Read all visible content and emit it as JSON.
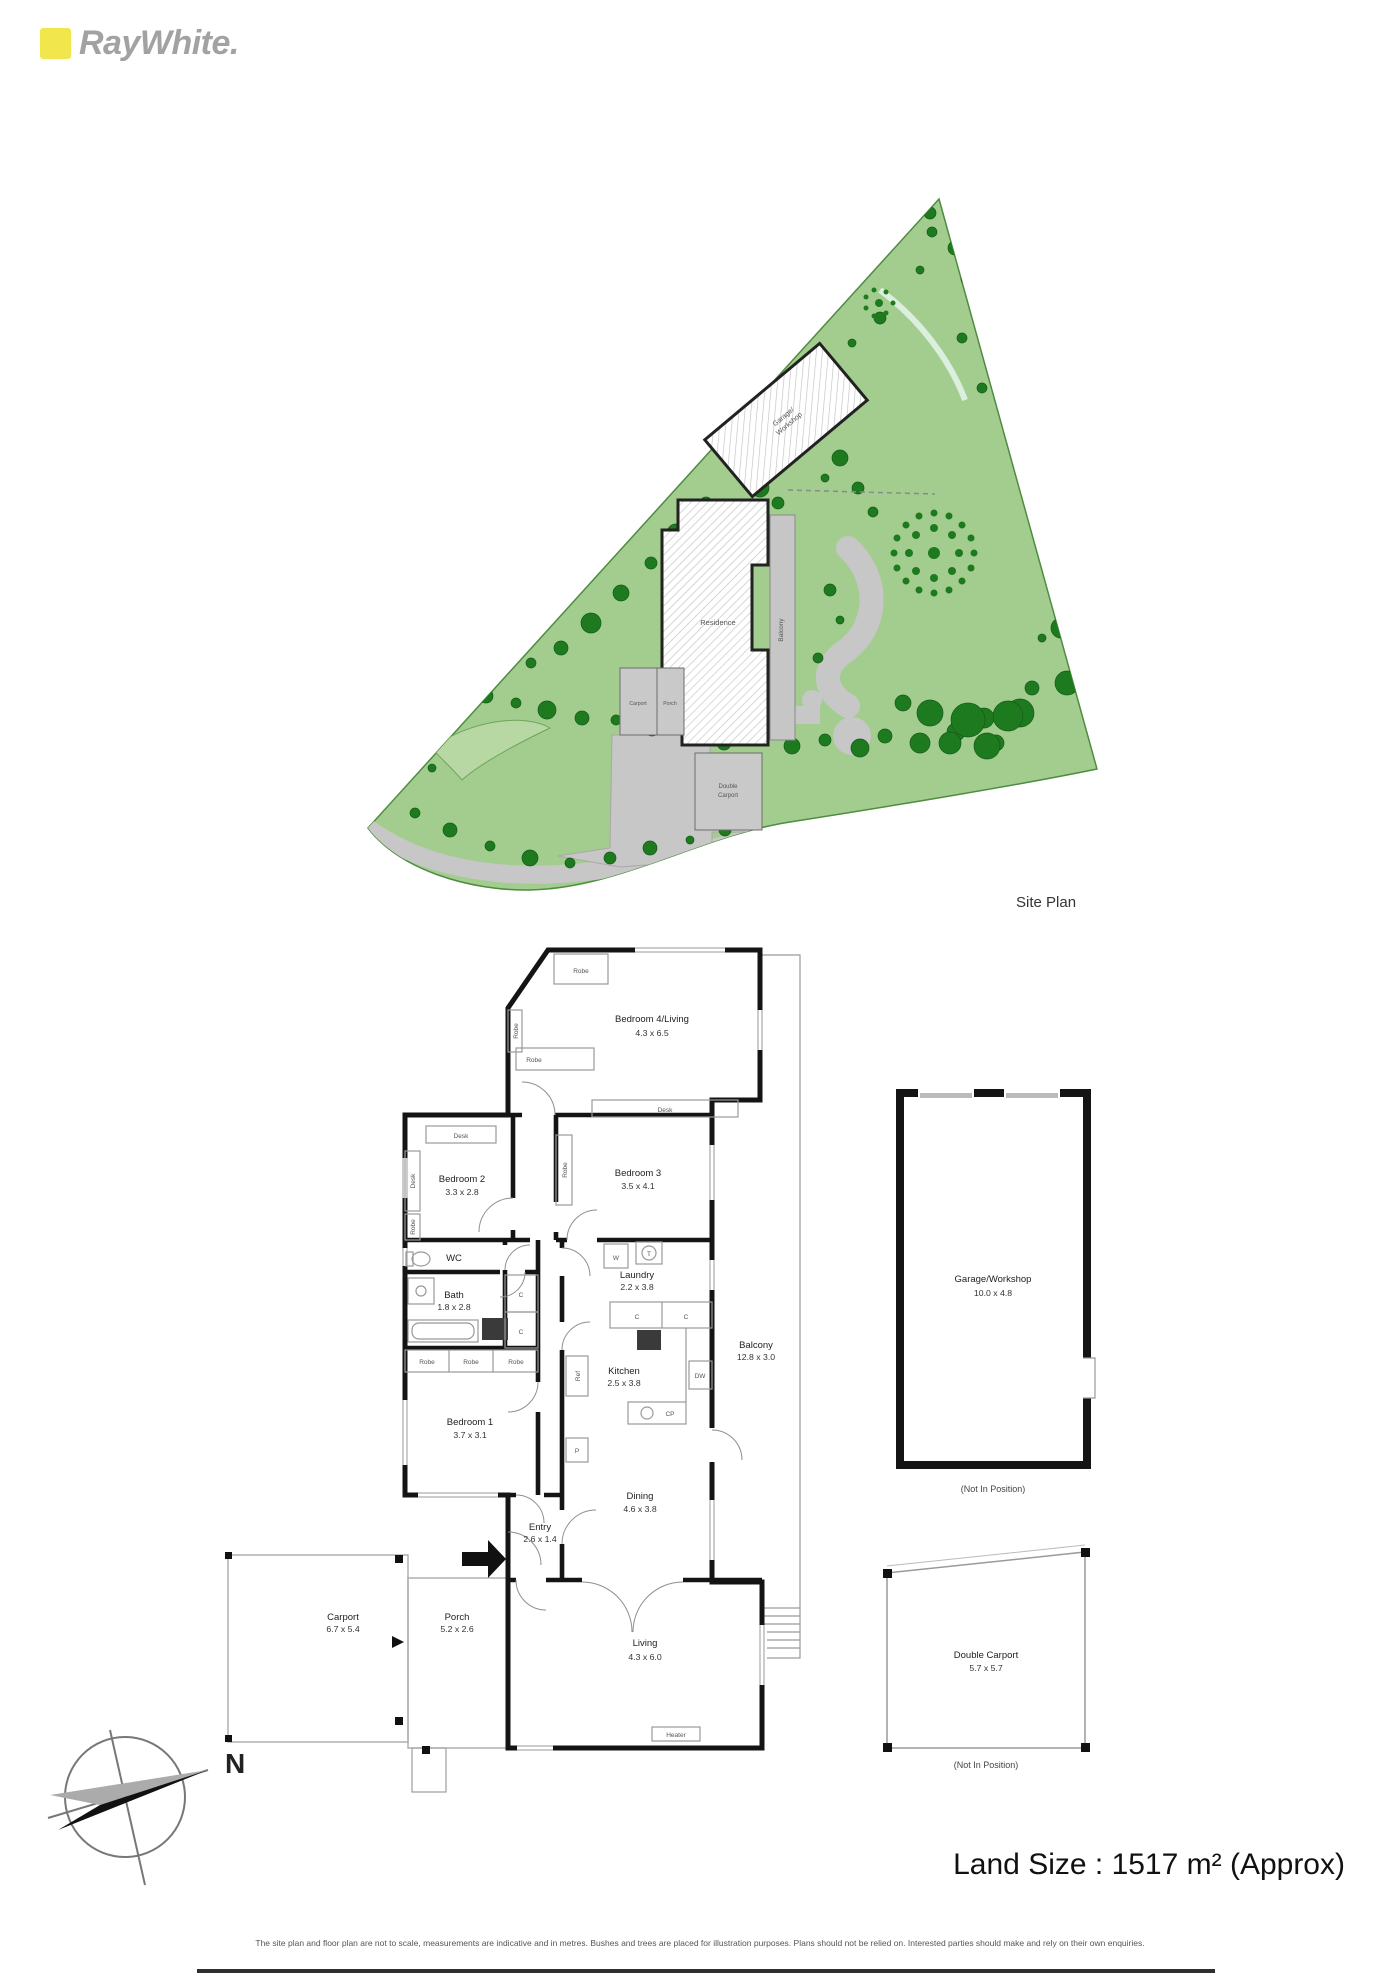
{
  "brand": {
    "name": "RayWhite."
  },
  "colors": {
    "accent_yellow": "#f2e64d",
    "grass": "#a3cd8e",
    "tree_dark": "#1e7a1f",
    "driveway": "#c7c7c7"
  },
  "site_plan": {
    "caption": "Site Plan",
    "garage_line1": "Garage/",
    "garage_line2": "Workshop",
    "residence": "Residence",
    "balcony": "Balcony",
    "carport": "Carport",
    "porch": "Porch",
    "double_carport_line1": "Double",
    "double_carport_line2": "Carport"
  },
  "floor_plan": {
    "bed4": {
      "name": "Bedroom 4/Living",
      "dims": "4.3 x 6.5"
    },
    "bed3": {
      "name": "Bedroom 3",
      "dims": "3.5 x 4.1"
    },
    "bed2": {
      "name": "Bedroom 2",
      "dims": "3.3 x 2.8"
    },
    "bed1": {
      "name": "Bedroom 1",
      "dims": "3.7 x 3.1"
    },
    "bath": {
      "name": "Bath",
      "dims": "1.8 x 2.8"
    },
    "wc": {
      "name": "WC"
    },
    "laundry": {
      "name": "Laundry",
      "dims": "2.2 x 3.8"
    },
    "kitchen": {
      "name": "Kitchen",
      "dims": "2.5 x 3.8"
    },
    "dining": {
      "name": "Dining",
      "dims": "4.6 x 3.8"
    },
    "entry": {
      "name": "Entry",
      "dims": "2.6 x 1.4"
    },
    "living": {
      "name": "Living",
      "dims": "4.3 x 6.0"
    },
    "porch": {
      "name": "Porch",
      "dims": "5.2 x 2.6"
    },
    "carport": {
      "name": "Carport",
      "dims": "6.7 x 5.4"
    },
    "balcony": {
      "name": "Balcony",
      "dims": "12.8 x 3.0"
    },
    "garage": {
      "name": "Garage/Workshop",
      "dims": "10.0 x 4.8",
      "note": "(Not In Position)"
    },
    "double_carport": {
      "name": "Double Carport",
      "dims": "5.7 x 5.7",
      "note": "(Not In Position)"
    },
    "furn": {
      "robe": "Robe",
      "desk": "Desk",
      "heater": "Heater",
      "w": "W",
      "t": "T",
      "c": "C",
      "ref": "Ref",
      "p": "P",
      "dw": "DW",
      "cp": "CP"
    }
  },
  "compass": {
    "north": "N"
  },
  "footer": {
    "land_size": "Land Size : 1517 m² (Approx)",
    "disclaimer": "The site plan and floor plan are not to scale, measurements are indicative and in metres. Bushes and trees are placed for illustration purposes. Plans should not be relied on. Interested parties should make and rely on their own enquiries."
  }
}
